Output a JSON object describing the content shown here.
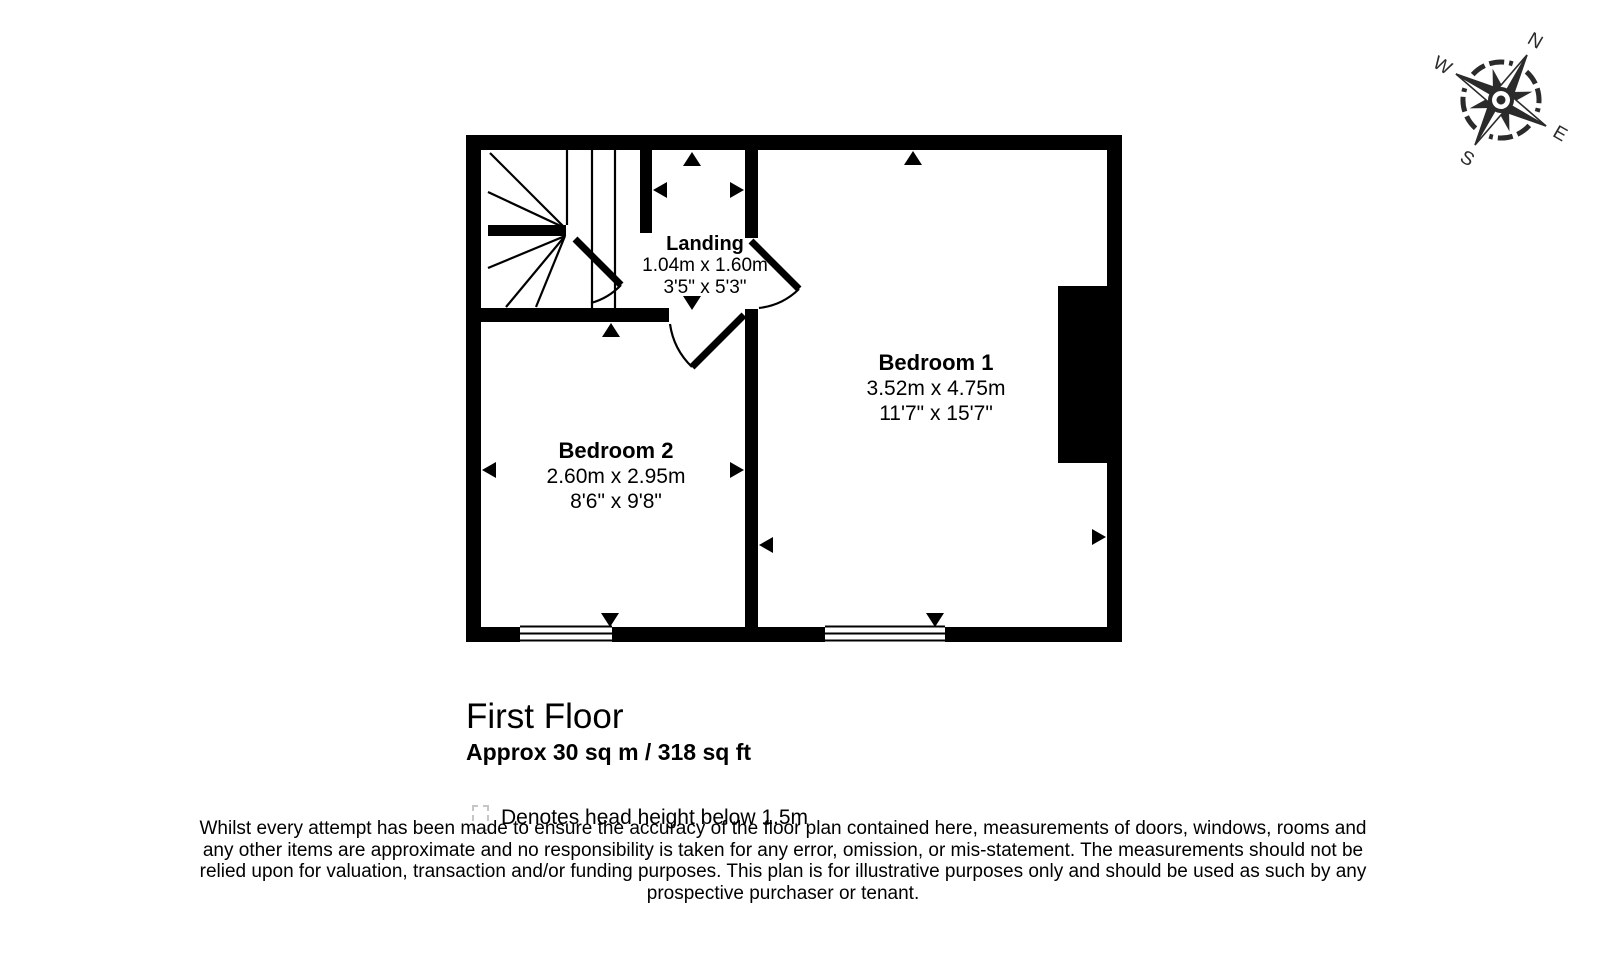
{
  "compass": {
    "north": "N",
    "east": "E",
    "south": "S",
    "west": "W"
  },
  "rooms": {
    "bedroom1": {
      "name": "Bedroom 1",
      "metric": "3.52m x 4.75m",
      "imperial": "11'7\" x 15'7\""
    },
    "bedroom2": {
      "name": "Bedroom 2",
      "metric": "2.60m x 2.95m",
      "imperial": "8'6\" x 9'8\""
    },
    "landing": {
      "name": "Landing",
      "metric": "1.04m x 1.60m",
      "imperial": "3'5\" x 5'3\""
    }
  },
  "floor": {
    "title": "First Floor",
    "area": "Approx 30 sq m / 318 sq ft"
  },
  "legend": {
    "head_height_note": "Denotes head height below 1.5m"
  },
  "disclaimer": "Whilst every attempt has been made to ensure the accuracy of the floor plan contained here, measurements of doors, windows, rooms and any other items are approximate and no responsibility is taken for any error, omission, or mis-statement. The measurements should not be relied upon for valuation, transaction and/or funding purposes. This plan is for illustrative purposes only and should be used as such by any prospective purchaser or tenant."
}
